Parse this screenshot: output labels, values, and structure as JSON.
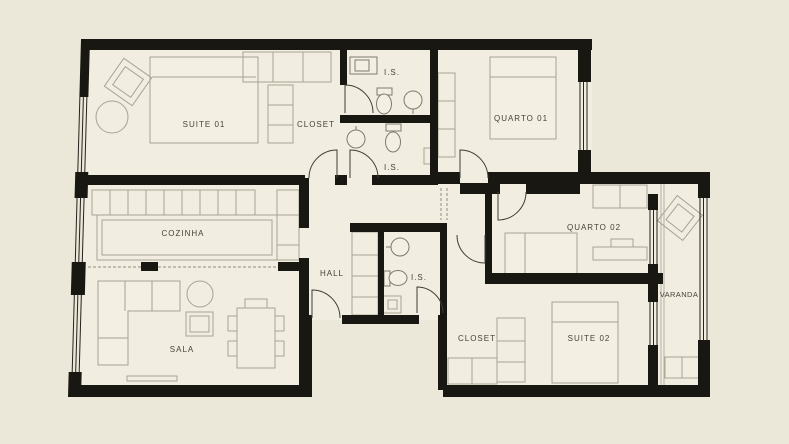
{
  "plan": {
    "title": "apartment-floor-plan",
    "colors": {
      "canvas": "#ebe7d9",
      "floor": "#f1ede0",
      "wall": "#191712",
      "furniture_line": "#a7a294",
      "label_text": "#45443a"
    },
    "rooms": {
      "suite01": {
        "label": "SUITE 01"
      },
      "closet_top": {
        "label": "CLOSET"
      },
      "is_top": {
        "label": "I.S."
      },
      "is_upper_mid": {
        "label": "I.S."
      },
      "quarto01": {
        "label": "QUARTO 01"
      },
      "cozinha": {
        "label": "COZINHA"
      },
      "hall": {
        "label": "HALL"
      },
      "is_center": {
        "label": "I.S."
      },
      "quarto02": {
        "label": "QUARTO 02"
      },
      "varanda": {
        "label": "VARANDA"
      },
      "closet_bottom": {
        "label": "CLOSET"
      },
      "suite02": {
        "label": "SUITE 02"
      },
      "sala": {
        "label": "SALA"
      }
    }
  }
}
